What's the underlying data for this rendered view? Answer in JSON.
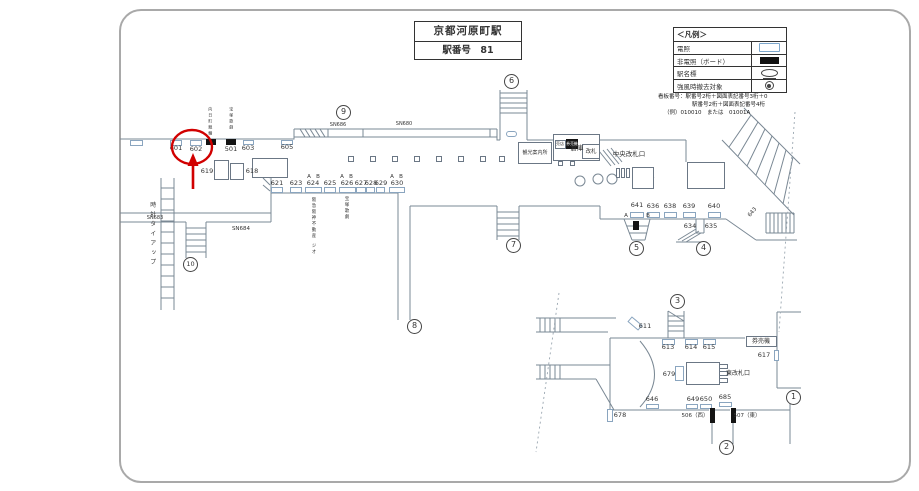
{
  "meta": {
    "station": "京都河原町駅",
    "station_no": "駅番号　81"
  },
  "legend": {
    "header": "＜凡例＞",
    "rows": [
      {
        "label": "電照",
        "symbol": "lit-board"
      },
      {
        "label": "非電照（ボード）",
        "symbol": "unlit-board"
      },
      {
        "label": "駅名標",
        "symbol": "station-sign"
      },
      {
        "label": "強風時撤去対象",
        "symbol": "wind-removal"
      }
    ]
  },
  "note": {
    "line1": "看板番号：駅番号2桁＋図面表記番号3桁＋0",
    "line2": "駅番号2桁＋図面表記番号4桁",
    "line3": "（例）010010　または　01001A"
  },
  "colors": {
    "annotation": "#d10000",
    "board_outline": "#8aa5bf",
    "line": "#7a8894",
    "text": "#333333"
  },
  "diagram": {
    "labels": [
      {
        "t": "601",
        "x": 176,
        "y": 148
      },
      {
        "t": "602",
        "x": 196,
        "y": 149
      },
      {
        "t": "501",
        "x": 231,
        "y": 149
      },
      {
        "t": "603",
        "x": 248,
        "y": 148
      },
      {
        "t": "605",
        "x": 287,
        "y": 147
      },
      {
        "t": "619",
        "x": 207,
        "y": 171
      },
      {
        "t": "618",
        "x": 252,
        "y": 171
      },
      {
        "t": "SN683",
        "x": 155,
        "y": 218,
        "s": 5
      },
      {
        "t": "SN684",
        "x": 241,
        "y": 228,
        "s": 5.5
      },
      {
        "t": "SN686",
        "x": 338,
        "y": 125,
        "s": 5
      },
      {
        "t": "SN680",
        "x": 404,
        "y": 124,
        "s": 5
      },
      {
        "t": "倉庫",
        "x": 577,
        "y": 148,
        "s": 6.5
      },
      {
        "t": "621",
        "x": 277,
        "y": 183
      },
      {
        "t": "623",
        "x": 296,
        "y": 183
      },
      {
        "t": "624",
        "x": 313,
        "y": 183
      },
      {
        "t": "625",
        "x": 330,
        "y": 183
      },
      {
        "t": "626",
        "x": 347,
        "y": 183
      },
      {
        "t": "627",
        "x": 361,
        "y": 183
      },
      {
        "t": "628",
        "x": 371,
        "y": 183
      },
      {
        "t": "629",
        "x": 381,
        "y": 183
      },
      {
        "t": "630",
        "x": 397,
        "y": 183
      },
      {
        "t": "A",
        "x": 309,
        "y": 176,
        "s": 5.5
      },
      {
        "t": "B",
        "x": 318,
        "y": 176,
        "s": 5.5
      },
      {
        "t": "A",
        "x": 342,
        "y": 176,
        "s": 5.5
      },
      {
        "t": "B",
        "x": 351,
        "y": 176,
        "s": 5.5
      },
      {
        "t": "A",
        "x": 392,
        "y": 176,
        "s": 5.5
      },
      {
        "t": "B",
        "x": 401,
        "y": 176,
        "s": 5.5
      },
      {
        "t": "観光案内所",
        "x": 535,
        "y": 153,
        "s": 5
      },
      {
        "t": "売店",
        "x": 560,
        "y": 144,
        "s": 4
      },
      {
        "t": "券売機",
        "x": 572,
        "y": 144,
        "s": 3.8,
        "white": true
      },
      {
        "t": "改札",
        "x": 591,
        "y": 151,
        "s": 5.5
      },
      {
        "t": "中央改札口",
        "x": 629,
        "y": 154,
        "s": 6.5
      },
      {
        "t": "641",
        "x": 637,
        "y": 205
      },
      {
        "t": "A",
        "x": 626,
        "y": 215,
        "s": 5.5
      },
      {
        "t": "B",
        "x": 648,
        "y": 215,
        "s": 5.5
      },
      {
        "t": "636",
        "x": 653,
        "y": 206
      },
      {
        "t": "638",
        "x": 670,
        "y": 206
      },
      {
        "t": "639",
        "x": 689,
        "y": 206
      },
      {
        "t": "640",
        "x": 714,
        "y": 206
      },
      {
        "t": "634",
        "x": 690,
        "y": 226
      },
      {
        "t": "635",
        "x": 711,
        "y": 226
      },
      {
        "t": "643",
        "x": 752,
        "y": 212,
        "s": 5.5,
        "rot": -50
      },
      {
        "t": "611",
        "x": 645,
        "y": 326
      },
      {
        "t": "613",
        "x": 668,
        "y": 347
      },
      {
        "t": "614",
        "x": 691,
        "y": 347
      },
      {
        "t": "615",
        "x": 709,
        "y": 347
      },
      {
        "t": "券売機",
        "x": 761,
        "y": 341,
        "s": 6
      },
      {
        "t": "617",
        "x": 764,
        "y": 355
      },
      {
        "t": "679",
        "x": 669,
        "y": 374
      },
      {
        "t": "東改札口",
        "x": 738,
        "y": 373,
        "s": 6
      },
      {
        "t": "646",
        "x": 652,
        "y": 399
      },
      {
        "t": "649",
        "x": 693,
        "y": 399
      },
      {
        "t": "650",
        "x": 706,
        "y": 399
      },
      {
        "t": "685",
        "x": 725,
        "y": 397
      },
      {
        "t": "678",
        "x": 620,
        "y": 415
      },
      {
        "t": "506（西）",
        "x": 695,
        "y": 415,
        "s": 5.5
      },
      {
        "t": "507（東）",
        "x": 747,
        "y": 415,
        "s": 5.5
      },
      {
        "t": "時計タイアップ",
        "x": 153,
        "y": 235,
        "s": 6,
        "vert": true,
        "ls": 7
      },
      {
        "t": "向日町競輪",
        "x": 210,
        "y": 122,
        "s": 4,
        "vert": true,
        "ls": 4
      },
      {
        "t": "宝塚歌劇",
        "x": 231,
        "y": 119,
        "s": 4,
        "vert": true,
        "ls": 4
      },
      {
        "t": "阪急阪神不動産",
        "x": 313,
        "y": 218,
        "s": 4.5,
        "vert": true,
        "ls": 3
      },
      {
        "t": "ジオ",
        "x": 313,
        "y": 249,
        "s": 4.5,
        "vert": true,
        "ls": 3
      },
      {
        "t": "宝塚歌劇",
        "x": 346,
        "y": 208,
        "s": 4.5,
        "vert": true,
        "ls": 3
      }
    ],
    "circled": [
      {
        "n": "1",
        "x": 793,
        "y": 397
      },
      {
        "n": "2",
        "x": 726,
        "y": 447
      },
      {
        "n": "3",
        "x": 677,
        "y": 301
      },
      {
        "n": "4",
        "x": 703,
        "y": 248
      },
      {
        "n": "5",
        "x": 636,
        "y": 248
      },
      {
        "n": "6",
        "x": 511,
        "y": 81
      },
      {
        "n": "7",
        "x": 513,
        "y": 245
      },
      {
        "n": "8",
        "x": 414,
        "y": 326
      },
      {
        "n": "9",
        "x": 343,
        "y": 112
      },
      {
        "n": "10",
        "x": 190,
        "y": 264
      }
    ],
    "boards_white": [
      {
        "x": 130,
        "y": 140,
        "w": 13,
        "h": 6
      },
      {
        "x": 170,
        "y": 140,
        "w": 12,
        "h": 6
      },
      {
        "x": 190,
        "y": 140,
        "w": 12,
        "h": 6
      },
      {
        "x": 243,
        "y": 140,
        "w": 11,
        "h": 5
      },
      {
        "x": 281,
        "y": 140,
        "w": 12,
        "h": 5
      },
      {
        "x": 271,
        "y": 187,
        "w": 12,
        "h": 6
      },
      {
        "x": 290,
        "y": 187,
        "w": 12,
        "h": 6
      },
      {
        "x": 305,
        "y": 187,
        "w": 17,
        "h": 6
      },
      {
        "x": 324,
        "y": 187,
        "w": 12,
        "h": 6
      },
      {
        "x": 339,
        "y": 187,
        "w": 17,
        "h": 6
      },
      {
        "x": 356,
        "y": 187,
        "w": 10,
        "h": 6
      },
      {
        "x": 366,
        "y": 187,
        "w": 9,
        "h": 6
      },
      {
        "x": 376,
        "y": 187,
        "w": 9,
        "h": 6
      },
      {
        "x": 389,
        "y": 187,
        "w": 16,
        "h": 6
      },
      {
        "x": 630,
        "y": 212,
        "w": 14,
        "h": 6
      },
      {
        "x": 647,
        "y": 212,
        "w": 13,
        "h": 6
      },
      {
        "x": 664,
        "y": 212,
        "w": 13,
        "h": 6
      },
      {
        "x": 683,
        "y": 212,
        "w": 13,
        "h": 6
      },
      {
        "x": 708,
        "y": 212,
        "w": 13,
        "h": 6
      },
      {
        "x": 662,
        "y": 339,
        "w": 13,
        "h": 6
      },
      {
        "x": 685,
        "y": 339,
        "w": 13,
        "h": 6
      },
      {
        "x": 703,
        "y": 339,
        "w": 13,
        "h": 6
      },
      {
        "x": 646,
        "y": 404,
        "w": 13,
        "h": 5
      },
      {
        "x": 686,
        "y": 404,
        "w": 12,
        "h": 5
      },
      {
        "x": 700,
        "y": 404,
        "w": 12,
        "h": 5
      },
      {
        "x": 719,
        "y": 402,
        "w": 13,
        "h": 5
      },
      {
        "x": 628,
        "y": 320,
        "w": 14,
        "h": 7,
        "rot": 40
      },
      {
        "x": 774,
        "y": 350,
        "w": 5,
        "h": 11
      },
      {
        "x": 607,
        "y": 409,
        "w": 6,
        "h": 13
      },
      {
        "x": 675,
        "y": 366,
        "w": 9,
        "h": 15
      },
      {
        "x": 506,
        "y": 131,
        "w": 11,
        "h": 6,
        "r": 3
      }
    ],
    "boards_black": [
      {
        "x": 206,
        "y": 139,
        "w": 10,
        "h": 6
      },
      {
        "x": 226,
        "y": 139,
        "w": 10,
        "h": 6
      },
      {
        "x": 566,
        "y": 139,
        "w": 12,
        "h": 10
      },
      {
        "x": 633,
        "y": 221,
        "w": 6,
        "h": 9
      },
      {
        "x": 710,
        "y": 408,
        "w": 5,
        "h": 15
      },
      {
        "x": 731,
        "y": 408,
        "w": 5,
        "h": 15
      }
    ],
    "boxes": [
      {
        "x": 214,
        "y": 160,
        "w": 15,
        "h": 20
      },
      {
        "x": 230,
        "y": 163,
        "w": 14,
        "h": 17
      },
      {
        "x": 252,
        "y": 158,
        "w": 36,
        "h": 20
      },
      {
        "x": 553,
        "y": 134,
        "w": 47,
        "h": 27,
        "n": "warehouse-box"
      },
      {
        "x": 518,
        "y": 142,
        "w": 34,
        "h": 22,
        "n": "tourist-info-box"
      },
      {
        "x": 555,
        "y": 140,
        "w": 11,
        "h": 9,
        "n": "shop-box"
      },
      {
        "x": 582,
        "y": 144,
        "w": 18,
        "h": 15,
        "n": "central-gate-box"
      },
      {
        "x": 687,
        "y": 162,
        "w": 38,
        "h": 27,
        "n": "arrows-box"
      },
      {
        "x": 746,
        "y": 336,
        "w": 31,
        "h": 11,
        "n": "ticket-machine-box"
      },
      {
        "x": 686,
        "y": 362,
        "w": 34,
        "h": 23,
        "n": "east-gate-box"
      },
      {
        "x": 632,
        "y": 167,
        "w": 22,
        "h": 22,
        "n": "stairs-box"
      },
      {
        "x": 616,
        "y": 168,
        "w": 4,
        "h": 10
      },
      {
        "x": 621,
        "y": 168,
        "w": 4,
        "h": 10
      },
      {
        "x": 626,
        "y": 168,
        "w": 4,
        "h": 10
      },
      {
        "x": 719,
        "y": 364,
        "w": 9,
        "h": 5
      },
      {
        "x": 719,
        "y": 371,
        "w": 9,
        "h": 5
      },
      {
        "x": 719,
        "y": 378,
        "w": 9,
        "h": 5
      },
      {
        "x": 348,
        "y": 156,
        "w": 6,
        "h": 6
      },
      {
        "x": 370,
        "y": 156,
        "w": 6,
        "h": 6
      },
      {
        "x": 392,
        "y": 156,
        "w": 6,
        "h": 6
      },
      {
        "x": 414,
        "y": 156,
        "w": 6,
        "h": 6
      },
      {
        "x": 436,
        "y": 156,
        "w": 6,
        "h": 6
      },
      {
        "x": 458,
        "y": 156,
        "w": 6,
        "h": 6
      },
      {
        "x": 480,
        "y": 156,
        "w": 6,
        "h": 6
      },
      {
        "x": 499,
        "y": 156,
        "w": 6,
        "h": 6
      },
      {
        "x": 558,
        "y": 161,
        "w": 5,
        "h": 5
      },
      {
        "x": 570,
        "y": 161,
        "w": 5,
        "h": 5
      }
    ]
  }
}
